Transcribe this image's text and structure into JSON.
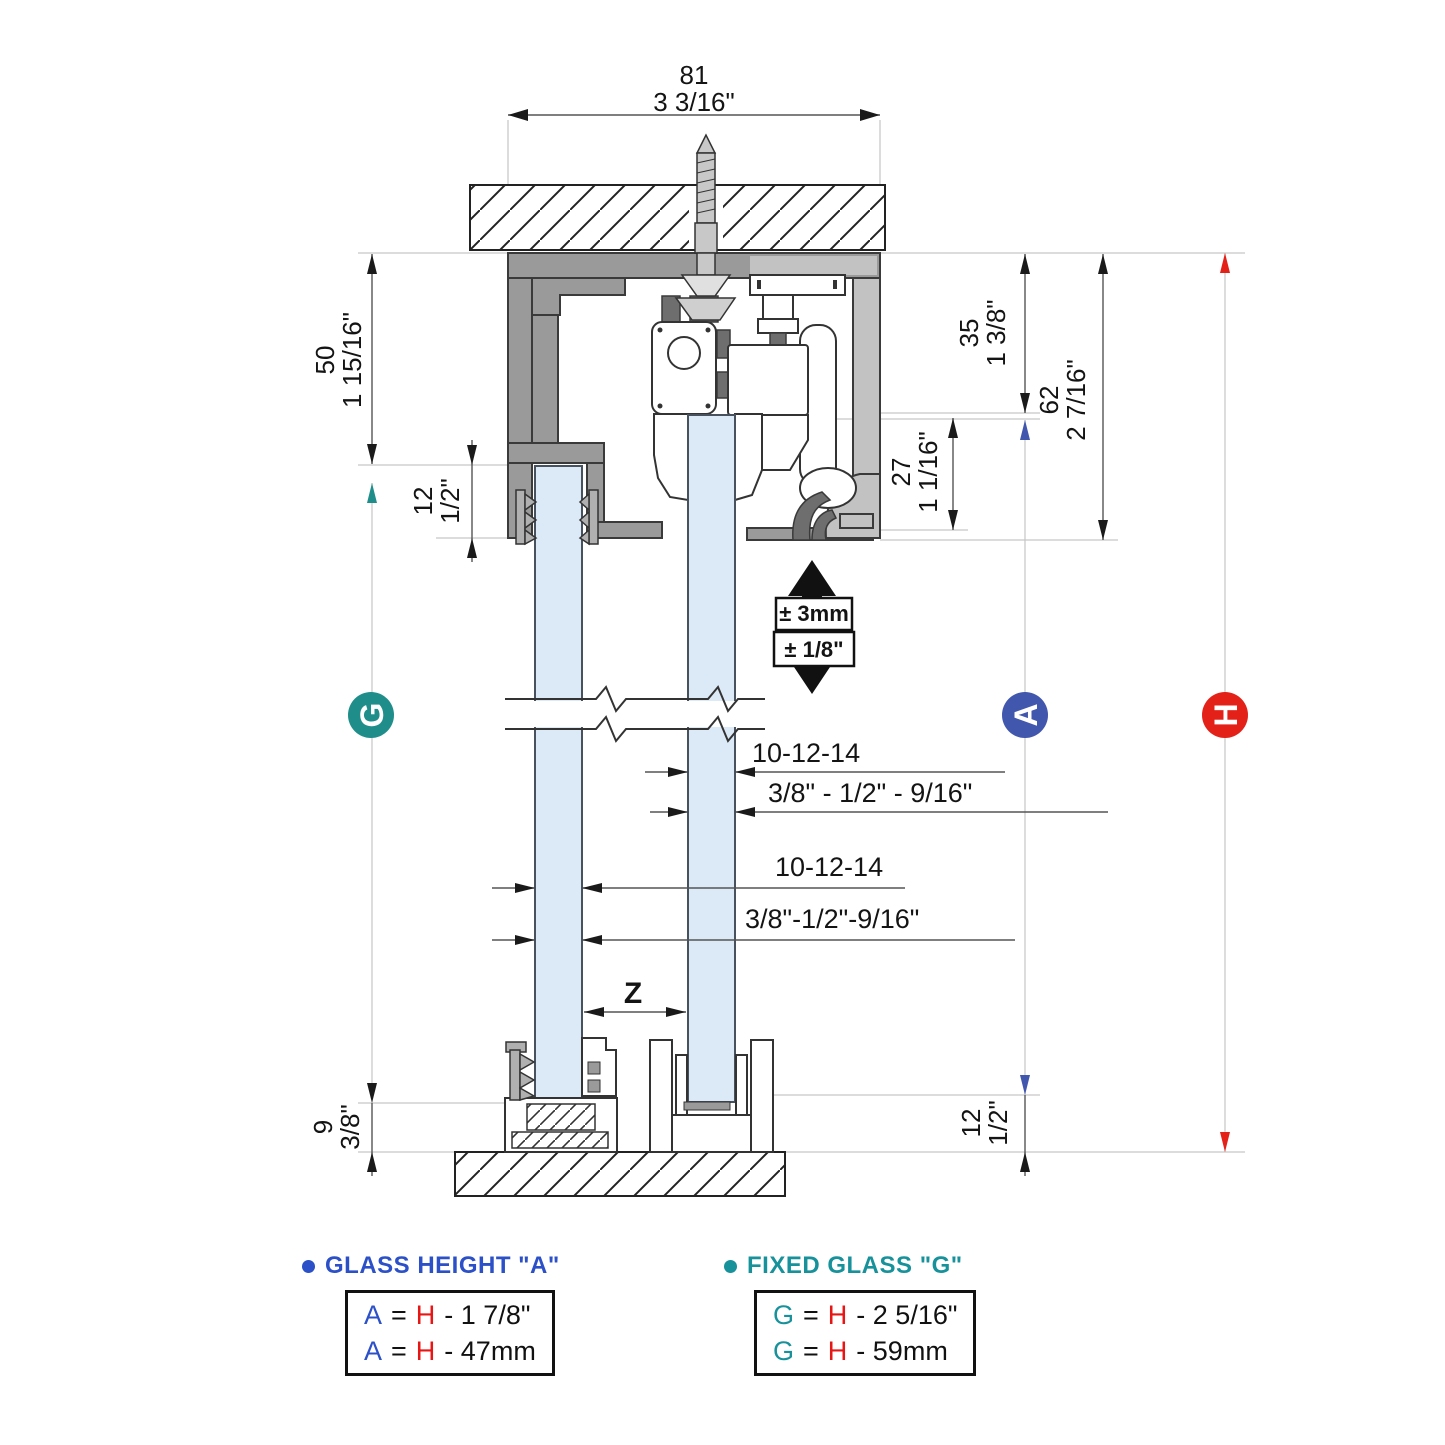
{
  "colors": {
    "track_gray": "#9a9a9a",
    "cover_gray": "#c2c2c2",
    "glass_blue": "#dce9f6",
    "marker_teal": "#1f8e8a",
    "marker_blue": "#4156ad",
    "marker_red": "#e32119",
    "legend_blue": "#2b50c8",
    "legend_teal": "#17929b",
    "legend_red": "#e81515"
  },
  "dimensions": {
    "track_width": {
      "mm": "81",
      "inch": "3 3/16\""
    },
    "top_height": {
      "mm": "50",
      "inch": "1 15/16\""
    },
    "fixed_inset_top": {
      "mm": "12",
      "inch": "1/2\""
    },
    "hanger_height": {
      "mm": "35",
      "inch": "1 3/8\""
    },
    "track_depth": {
      "mm": "62",
      "inch": "2 7/16\""
    },
    "roller_clearance": {
      "mm": "27",
      "inch": "1 1/16\""
    },
    "fixed_inset_bottom": {
      "mm": "9",
      "inch": "3/8\""
    },
    "door_floor_gap": {
      "mm": "12",
      "inch": "1/2\""
    },
    "gap_label": "Z"
  },
  "adjustment": {
    "mm": "± 3mm",
    "inch": "± 1/8\""
  },
  "glass_thickness": {
    "sliding": {
      "mm": "10-12-14",
      "inch": "3/8\" - 1/2\" - 9/16\""
    },
    "fixed": {
      "mm": "10-12-14",
      "inch": "3/8\"-1/2\"-9/16\""
    }
  },
  "markers": {
    "fixed_glass": "G",
    "glass_height": "A",
    "overall_height": "H"
  },
  "legend": {
    "glass_height": {
      "title": "GLASS HEIGHT \"A\"",
      "rows": [
        {
          "sym": "A",
          "eq": "=",
          "h": "H",
          "expr": "- 1 7/8\""
        },
        {
          "sym": "A",
          "eq": "=",
          "h": "H",
          "expr": "- 47mm"
        }
      ]
    },
    "fixed_glass": {
      "title": "FIXED GLASS \"G\"",
      "rows": [
        {
          "sym": "G",
          "eq": "=",
          "h": "H",
          "expr": "- 2 5/16\""
        },
        {
          "sym": "G",
          "eq": "=",
          "h": "H",
          "expr": "- 59mm"
        }
      ]
    }
  }
}
